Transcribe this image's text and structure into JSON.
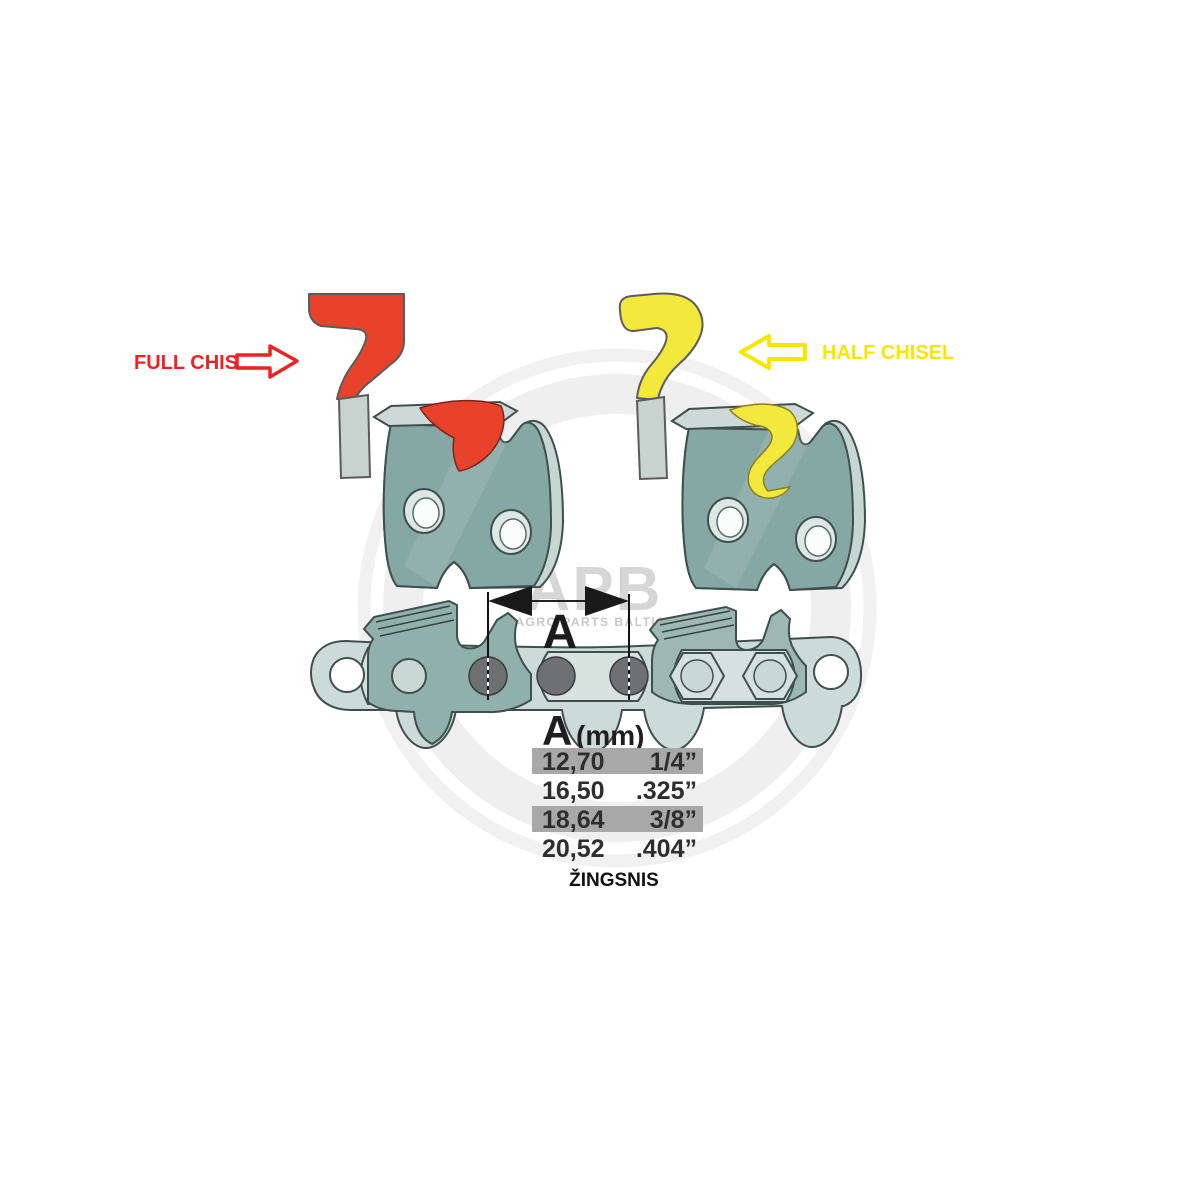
{
  "callouts": {
    "full_chisel": "FULL CHISEL",
    "half_chisel": "HALF CHISEL"
  },
  "dimension": {
    "label": "A"
  },
  "watermark": {
    "logo": "APB",
    "subtitle": "AGRO PARTS BALTIJA"
  },
  "pitch_table": {
    "header_letter": "A",
    "header_unit": "(mm)",
    "rows": [
      {
        "mm": "12,70",
        "inch": "1/4”",
        "highlighted": true
      },
      {
        "mm": "16,50",
        "inch": ".325”",
        "highlighted": false
      },
      {
        "mm": "18,64",
        "inch": "3/8”",
        "highlighted": true
      },
      {
        "mm": "20,52",
        "inch": ".404”",
        "highlighted": false
      }
    ],
    "caption": "ŽINGSNIS"
  },
  "colors": {
    "full_chisel_red": "#e9422b",
    "half_chisel_yellow": "#f3e83c",
    "callout_red": "#ee2222",
    "callout_yellow": "#f7e600",
    "cutter_teal": "#86a8a4",
    "chain_light": "#ccdbd7",
    "table_highlight_gray": "#a8a8a8"
  }
}
